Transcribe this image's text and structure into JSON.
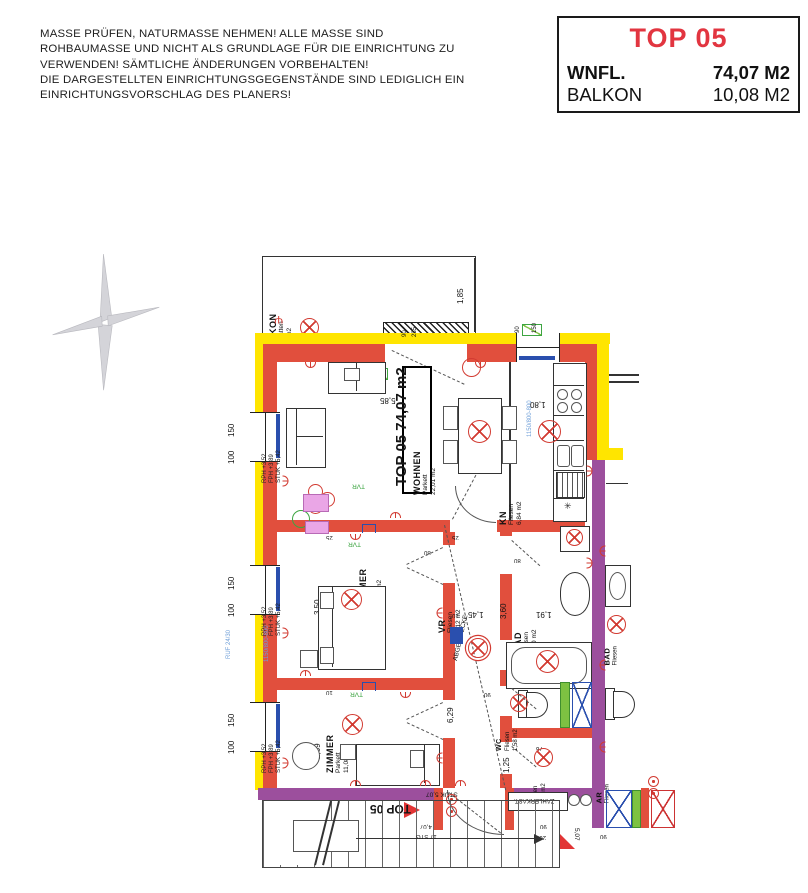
{
  "disclaimer": {
    "lines": [
      "MASSE PRÜFEN, NATURMASSE NEHMEN! ALLE MASSE SIND",
      "ROHBAUMASSE UND NICHT ALS GRUNDLAGE FÜR DIE EINRICHTUNG ZU",
      "VERWENDEN! SÄMTLICHE ÄNDERUNGEN VORBEHALTEN!",
      "DIE DARGESTELLTEN EINRICHTUNGSGEGENSTÄNDE SIND LEDIGLICH EIN",
      "EINRICHTUNGSVORSCHLAG DES PLANERS!"
    ]
  },
  "title_block": {
    "title": "TOP 05",
    "accent_color": "#e23540",
    "rows": [
      {
        "label": "WNFL.",
        "value": "74,07 M2"
      },
      {
        "label": "BALKON",
        "value": "10,08 M2"
      }
    ]
  },
  "plan": {
    "apartment_label": "TOP 05 74,07 m2",
    "rooms": {
      "balkon": {
        "name": "BALKON",
        "floor": "Bet. Platten",
        "area": "10,08 m2"
      },
      "wohnen": {
        "name": "WOHNEN",
        "floor": "Parkett",
        "area": "22,01 m2"
      },
      "kn": {
        "name": "KN",
        "floor": "Fliesen",
        "area": "6,84 m2"
      },
      "zimmer1": {
        "name": "ZIMMER",
        "floor": "Parkett",
        "area": "14,10 m2"
      },
      "zimmer2": {
        "name": "ZIMMER",
        "floor": "Parkett",
        "area": "11,08 m2"
      },
      "vr": {
        "name": "VR",
        "floor": "Fliesen",
        "area": "9,12 m2"
      },
      "bad": {
        "name": "BAD",
        "floor": "Fliesen",
        "area": "6,80 m2"
      },
      "wc": {
        "name": "WC",
        "floor": "Fliesen",
        "area": "1,58 m2"
      },
      "ar": {
        "name": "AR",
        "floor": "Fliesen",
        "area": "2,54 m2"
      },
      "nb_bad": {
        "name": "BAD",
        "floor": "Fliesen"
      },
      "nb_ar": {
        "name": "AR",
        "floor": "Fliesen"
      }
    },
    "window_levels": {
      "rph": "RPH +3,52",
      "fph": "FPH +3,89",
      "stuk": "STUK +5,42"
    },
    "dims": {
      "balcony_depth": "1,85",
      "top_width": "5,85",
      "wohnen_h": "3,80",
      "kn_h": "3,80",
      "kn_w": "1,80",
      "z1_h": "3,50",
      "z1_w": "4,09",
      "z2_h": "2,69",
      "vr_len": "6,29",
      "vr_w": "1,45",
      "bad_h": "3,60",
      "bad_w": "1,91",
      "wc_w": "1,37",
      "ar_h": "1,25",
      "w150": "150",
      "w100": "100",
      "kw90": "90",
      "kw150": "150",
      "t25": "25",
      "t10": "10",
      "d80": "80",
      "d76": "76",
      "d90": "90",
      "d200": "200",
      "bd235": "235",
      "bd90": "90",
      "stair_run": "4,07",
      "stairs": "17 STG"
    },
    "annotations": {
      "tvr": "TVR",
      "abgeh": "ABGEH.DECKE",
      "zaehler": "ZÄHLERKAST.",
      "stuk_entry": "STUK 5,07",
      "entry_top": "TOP 05",
      "stuk_bottom": "5,07",
      "ruf": "RUF 24/30",
      "window_spec": "1150/800-800",
      "snowflake": "✳",
      "fork": "Ψ"
    }
  }
}
